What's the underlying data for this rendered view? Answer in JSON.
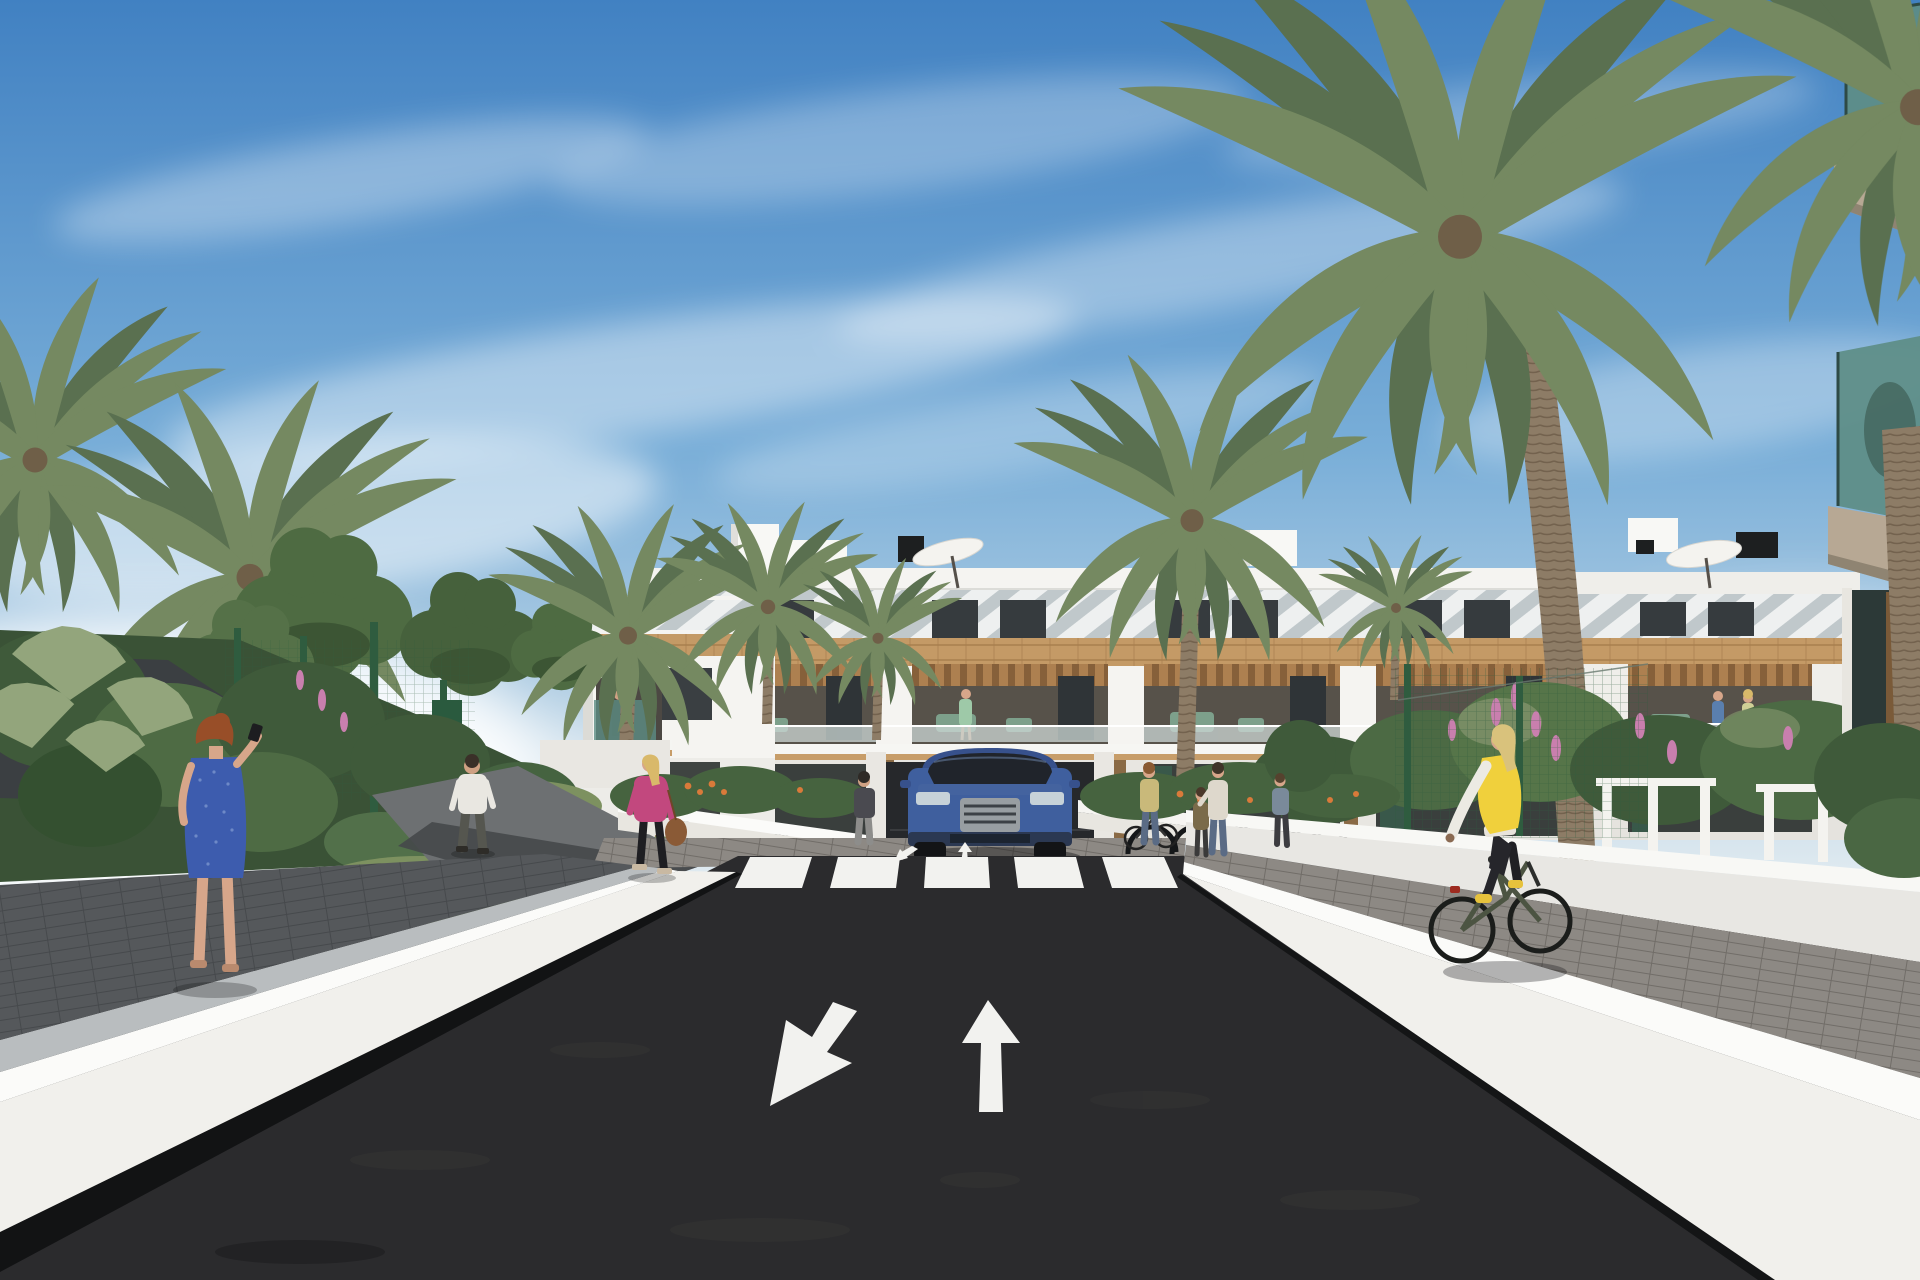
{
  "scene": {
    "type": "architectural-3d-rendering",
    "description": "Street-level 3D render of a modern white Mediterranean apartment complex: palm-lined asphalt road with lane arrows and zebra crosswalk, white retaining walls, garden shrubs, pedestrians, a blue SUV and a cyclist in a yellow vest",
    "colors": {
      "sky_top": "#4181c2",
      "sky_mid": "#79aed8",
      "sky_horizon": "#e6eef2",
      "cloud_white": "#ffffff",
      "building_white": "#f5f4f1",
      "building_shadow": "#e8e6e1",
      "louver_light": "#eef0f0",
      "louver_shadow": "#9aa7ad",
      "window_dark": "#363b3e",
      "wood_band": "#c49a66",
      "wood_joint": "#a87f4e",
      "pergola_wood": "#ad8050",
      "balcony_interior": "#57524a",
      "glass_rail": "#cdd8d6",
      "furniture_green": "#7da08b",
      "road_asphalt": "#2b2b2d",
      "road_marking": "#f2f2ef",
      "gutter_black": "#121314",
      "wall_white": "#f1f0ec",
      "wall_cap": "#fbfbf9",
      "wall_gray": "#b9bdbf",
      "path_dark": "#55585b",
      "path_pavers": "#8d8984",
      "path_asphalt": "#6d7072",
      "grass": "#7d9160",
      "tree_green": "#4e6b42",
      "bush_dark": "#3f5a3a",
      "palm_front": "#758961",
      "palm_back": "#5a7050",
      "fan_palm": "#93a57c",
      "trunk_brown": "#8d7c66",
      "fence_green": "#2f5c3f",
      "shade_sail": "#3b3f42",
      "car_blue": "#3f5f9e",
      "car_glass": "#20242b",
      "vest_yellow": "#f0d03c",
      "dress_blue": "#3d5cae",
      "jacket_pink": "#c2487e",
      "skin": "#d7a68a",
      "hair_auburn": "#984e28",
      "denim": "#5a6b85",
      "flower_pink": "#c97fae",
      "flower_orange": "#d97a3a",
      "glass_teal": "#5d8d85",
      "slab_tan": "#b7a894"
    },
    "objects": [
      "apartment-building",
      "rooftop-parasols",
      "rooftop-vents",
      "palm-trees",
      "leafy-trees",
      "shade-sail",
      "mesh-fence",
      "garden-shrubs",
      "pink-flower-shrubs",
      "orange-flowers",
      "asphalt-road",
      "zebra-crosswalk",
      "lane-arrow-towards-viewer",
      "lane-arrow-away",
      "retaining-walls",
      "dark-paved-walkway",
      "paver-path",
      "blue-suv",
      "garage-entrance",
      "bike-racks",
      "woman-on-phone-blue-dress",
      "man-white-tshirt",
      "woman-pink-jacket",
      "pedestrians-near-bike-racks",
      "cyclist-yellow-vest",
      "balcony-residents",
      "foreground-glass-balconies"
    ]
  }
}
